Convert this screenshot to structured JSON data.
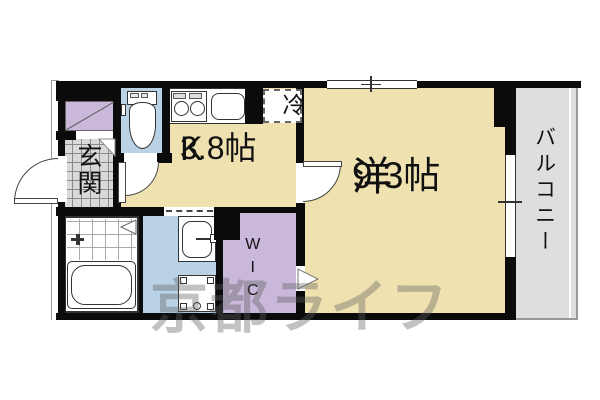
{
  "rooms": {
    "kitchen": {
      "name": "K",
      "size": "3.8帖"
    },
    "living": {
      "name": "洋",
      "size": "9.3帖"
    },
    "balcony": {
      "name": "バルコニー"
    },
    "entrance": {
      "name": "玄関"
    },
    "wic": {
      "name": "WIC"
    },
    "refrigerator": {
      "name": "冷"
    }
  },
  "watermark": {
    "text": "京都ライフ"
  },
  "colors": {
    "room": "#f0e2b0",
    "water": "#b9d2e5",
    "closet": "#c9b8da",
    "balcony": "#dedede",
    "entrance_tile": "#d9d9d9",
    "wall": "#0b0b0b"
  }
}
